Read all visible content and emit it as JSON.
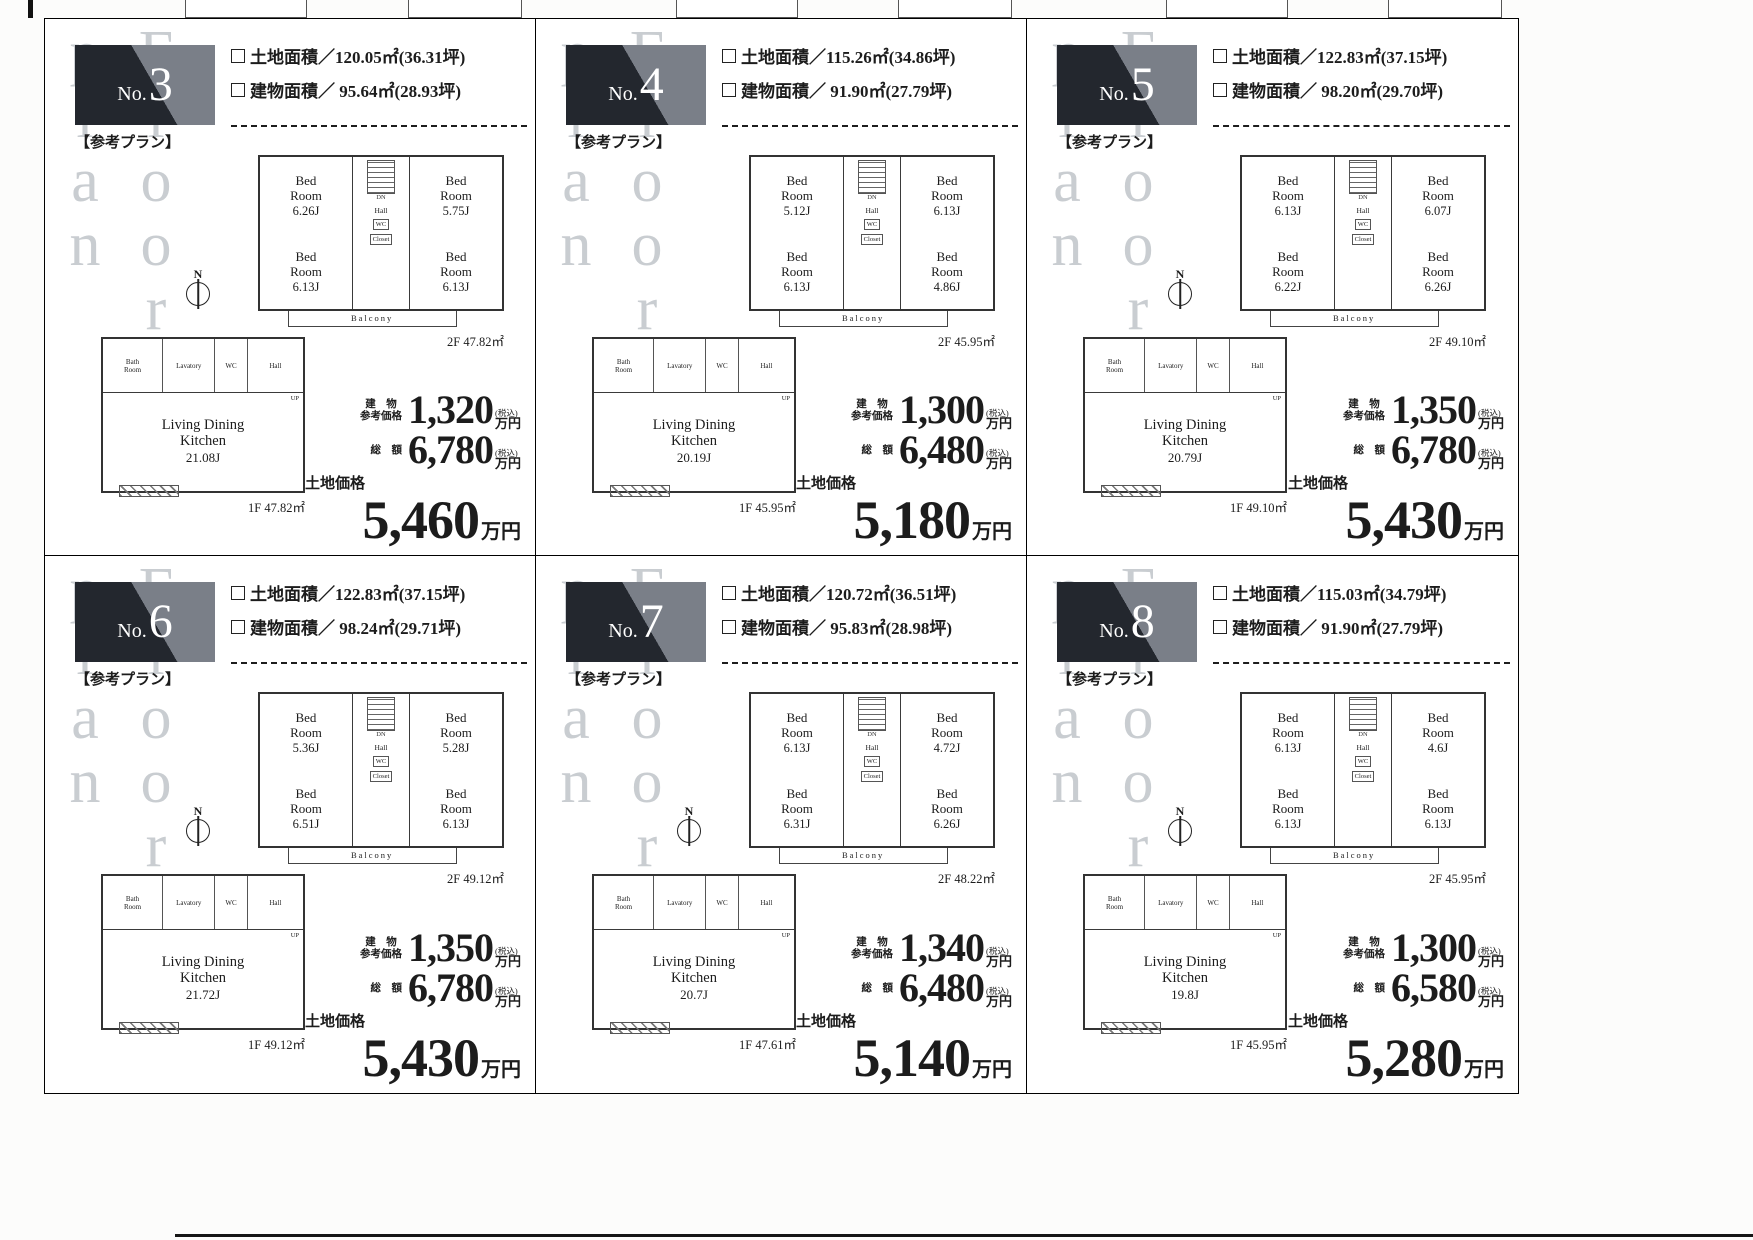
{
  "common": {
    "watermark": "Floor plan",
    "plan_note": "【参考プラン】",
    "no_prefix": "No.",
    "compass_n": "N",
    "building_price_label": "建　物\n参考価格",
    "total_price_label": "総　額",
    "tax_note": "(税込)",
    "unit": "万円",
    "land_price_label": "土地価格",
    "room_labels": {
      "hall": "Hall",
      "wc": "WC",
      "closet": "Closet",
      "dn": "DN",
      "up": "UP",
      "bath": "Bath Room",
      "lavatory": "Lavatory",
      "balcony": "Balcony",
      "ldk": "Living Dining Kitchen"
    },
    "colors": {
      "badge_dark": "#23272e",
      "badge_light": "#7a7f88",
      "watermark_gray": "#c9cdd1",
      "ink": "#1c1c1c"
    }
  },
  "panels": [
    {
      "no": "3",
      "land_area": "土地面積／120.05㎡(36.31坪)",
      "building_area": "建物面積／ 95.64㎡(28.93坪)",
      "has_compass": true,
      "floor2": {
        "rooms": [
          {
            "name": "Bed Room",
            "size": "6.26J"
          },
          {
            "name": "Bed Room",
            "size": "5.75J"
          },
          {
            "name": "Bed Room",
            "size": "6.13J"
          },
          {
            "name": "Bed Room",
            "size": "6.13J"
          }
        ],
        "area": "2F 47.82㎡"
      },
      "floor1": {
        "ldk_size": "21.08J",
        "area": "1F 47.82㎡"
      },
      "prices": {
        "building": "1,320",
        "total": "6,780",
        "land": "5,460"
      }
    },
    {
      "no": "4",
      "land_area": "土地面積／115.26㎡(34.86坪)",
      "building_area": "建物面積／ 91.90㎡(27.79坪)",
      "has_compass": false,
      "floor2": {
        "rooms": [
          {
            "name": "Bed Room",
            "size": "5.12J"
          },
          {
            "name": "Bed Room",
            "size": "6.13J"
          },
          {
            "name": "Bed Room",
            "size": "6.13J"
          },
          {
            "name": "Bed Room",
            "size": "4.86J"
          }
        ],
        "area": "2F 45.95㎡"
      },
      "floor1": {
        "ldk_size": "20.19J",
        "area": "1F 45.95㎡"
      },
      "prices": {
        "building": "1,300",
        "total": "6,480",
        "land": "5,180"
      }
    },
    {
      "no": "5",
      "land_area": "土地面積／122.83㎡(37.15坪)",
      "building_area": "建物面積／ 98.20㎡(29.70坪)",
      "has_compass": true,
      "floor2": {
        "rooms": [
          {
            "name": "Bed Room",
            "size": "6.13J"
          },
          {
            "name": "Bed Room",
            "size": "6.07J"
          },
          {
            "name": "Bed Room",
            "size": "6.22J"
          },
          {
            "name": "Bed Room",
            "size": "6.26J"
          }
        ],
        "area": "2F 49.10㎡"
      },
      "floor1": {
        "ldk_size": "20.79J",
        "area": "1F 49.10㎡"
      },
      "prices": {
        "building": "1,350",
        "total": "6,780",
        "land": "5,430"
      }
    },
    {
      "no": "6",
      "land_area": "土地面積／122.83㎡(37.15坪)",
      "building_area": "建物面積／ 98.24㎡(29.71坪)",
      "has_compass": true,
      "floor2": {
        "rooms": [
          {
            "name": "Bed Room",
            "size": "5.36J"
          },
          {
            "name": "Bed Room",
            "size": "5.28J"
          },
          {
            "name": "Bed Room",
            "size": "6.51J"
          },
          {
            "name": "Bed Room",
            "size": "6.13J"
          }
        ],
        "area": "2F 49.12㎡"
      },
      "floor1": {
        "ldk_size": "21.72J",
        "area": "1F 49.12㎡"
      },
      "prices": {
        "building": "1,350",
        "total": "6,780",
        "land": "5,430"
      }
    },
    {
      "no": "7",
      "land_area": "土地面積／120.72㎡(36.51坪)",
      "building_area": "建物面積／ 95.83㎡(28.98坪)",
      "has_compass": true,
      "floor2": {
        "rooms": [
          {
            "name": "Bed Room",
            "size": "6.13J"
          },
          {
            "name": "Bed Room",
            "size": "4.72J"
          },
          {
            "name": "Bed Room",
            "size": "6.31J"
          },
          {
            "name": "Bed Room",
            "size": "6.26J"
          }
        ],
        "area": "2F 48.22㎡"
      },
      "floor1": {
        "ldk_size": "20.7J",
        "area": "1F 47.61㎡"
      },
      "prices": {
        "building": "1,340",
        "total": "6,480",
        "land": "5,140"
      }
    },
    {
      "no": "8",
      "land_area": "土地面積／115.03㎡(34.79坪)",
      "building_area": "建物面積／ 91.90㎡(27.79坪)",
      "has_compass": true,
      "floor2": {
        "rooms": [
          {
            "name": "Bed Room",
            "size": "6.13J"
          },
          {
            "name": "Bed Room",
            "size": "4.6J"
          },
          {
            "name": "Bed Room",
            "size": "6.13J"
          },
          {
            "name": "Bed Room",
            "size": "6.13J"
          }
        ],
        "area": "2F 45.95㎡"
      },
      "floor1": {
        "ldk_size": "19.8J",
        "area": "1F 45.95㎡"
      },
      "prices": {
        "building": "1,300",
        "total": "6,580",
        "land": "5,280"
      }
    }
  ]
}
